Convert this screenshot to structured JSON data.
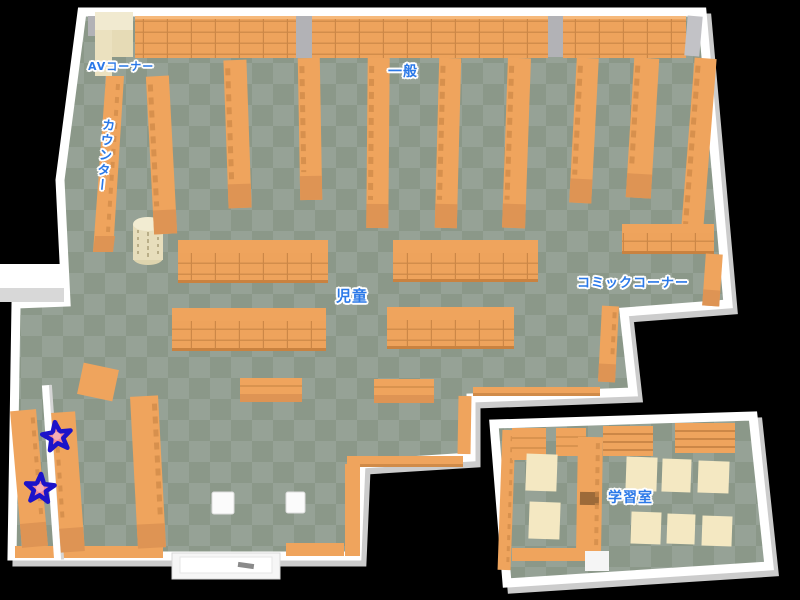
{
  "map": {
    "name": "library-floor-map",
    "areas": {
      "av_corner": {
        "label": "AVコーナー"
      },
      "general": {
        "label": "一般"
      },
      "counter": {
        "label": "カウンター"
      },
      "children": {
        "label": "児童"
      },
      "comic_corner": {
        "label": "コミックコーナー"
      },
      "study_room": {
        "label": "学習室"
      }
    },
    "markers": {
      "star_count": "2"
    },
    "colors": {
      "background": "#000000",
      "floor_light": "#96a296",
      "floor_dark": "#8b9889",
      "shelf": "#efa45d",
      "shelf_front": "#de9454",
      "shelf_line": "#d28d4b",
      "wall": "#ffffff",
      "wall_shadow": "#cccccc",
      "desk_cream": "#f4e8c2",
      "label_text": "#2b79e8",
      "star_fill": "#f28a95",
      "star_outline": "#1c13c9"
    }
  }
}
